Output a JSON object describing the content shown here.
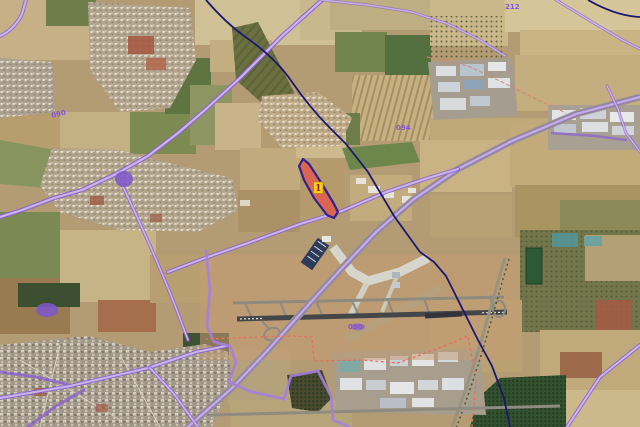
{
  "viewer": {
    "title": "Aerial orthophoto map with cadastral overlay",
    "map_type": "satellite"
  },
  "overlay": {
    "parcel": {
      "marker_label": "1"
    },
    "road_labels": [
      {
        "id": "topleft",
        "text": "090"
      },
      {
        "id": "topright",
        "text": "212"
      },
      {
        "id": "center",
        "text": "094"
      },
      {
        "id": "airport",
        "text": "090"
      }
    ],
    "colors": {
      "parcel_fill": "#dd6450",
      "parcel_stroke": "#2b1d8c",
      "marker_bg": "#f4d21c",
      "marker_border": "#b9840a",
      "marker_text": "#a01808",
      "road_casing": "#8a5fd0",
      "road_fill": "#c9b4ec",
      "boundary_navy": "#1c1870",
      "airport_boundary": "#e8705a",
      "zone_boundary": "#a580dc",
      "label_text": "#8a55d6",
      "purple_blob": "#7e57cc"
    }
  }
}
